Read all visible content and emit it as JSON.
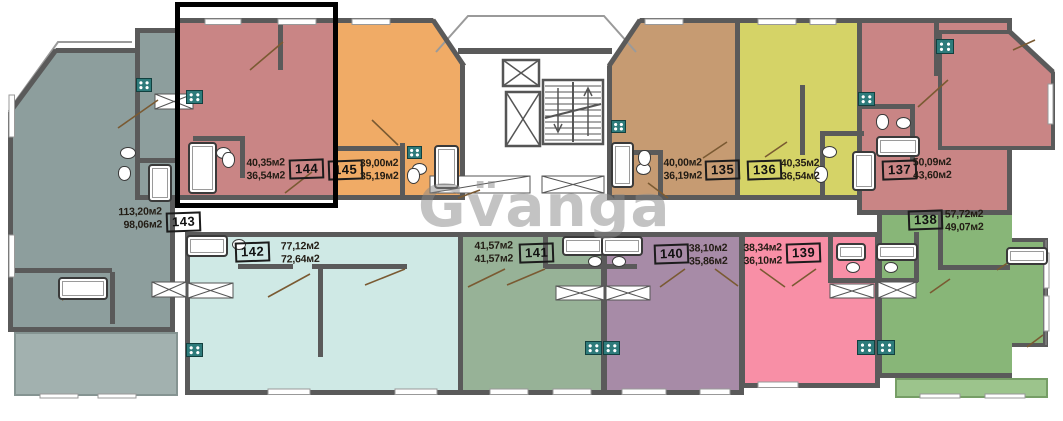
{
  "watermark": {
    "text": "Gv̈anga"
  },
  "units": [
    {
      "id": "143",
      "area_total": "113,20м2",
      "area_living": "98,06м2",
      "color": "#8d9e9d"
    },
    {
      "id": "144",
      "area_total": "40,35м2",
      "area_living": "36,54м2",
      "color": "#c98585"
    },
    {
      "id": "145",
      "area_total": "39,00м2",
      "area_living": "35,19м2",
      "color": "#f0ab66"
    },
    {
      "id": "135",
      "area_total": "40,00м2",
      "area_living": "36,19м2",
      "color": "#c69b72"
    },
    {
      "id": "136",
      "area_total": "40,35м2",
      "area_living": "36,54м2",
      "color": "#d5d367"
    },
    {
      "id": "137",
      "area_total": "50,09м2",
      "area_living": "43,60м2",
      "color": "#c98585"
    },
    {
      "id": "142",
      "area_total": "77,12м2",
      "area_living": "72,64м2",
      "color": "#cfe9e5"
    },
    {
      "id": "141",
      "area_total": "41,57м2",
      "area_living": "41,57м2",
      "color": "#97b297"
    },
    {
      "id": "140",
      "area_total": "38,10м2",
      "area_living": "35,86м2",
      "color": "#a78ba7"
    },
    {
      "id": "139",
      "area_total": "38,34м2",
      "area_living": "36,10м2",
      "color": "#f88fa6"
    },
    {
      "id": "138",
      "area_total": "57,72м2",
      "area_living": "49,07м2",
      "color": "#88b678"
    }
  ]
}
